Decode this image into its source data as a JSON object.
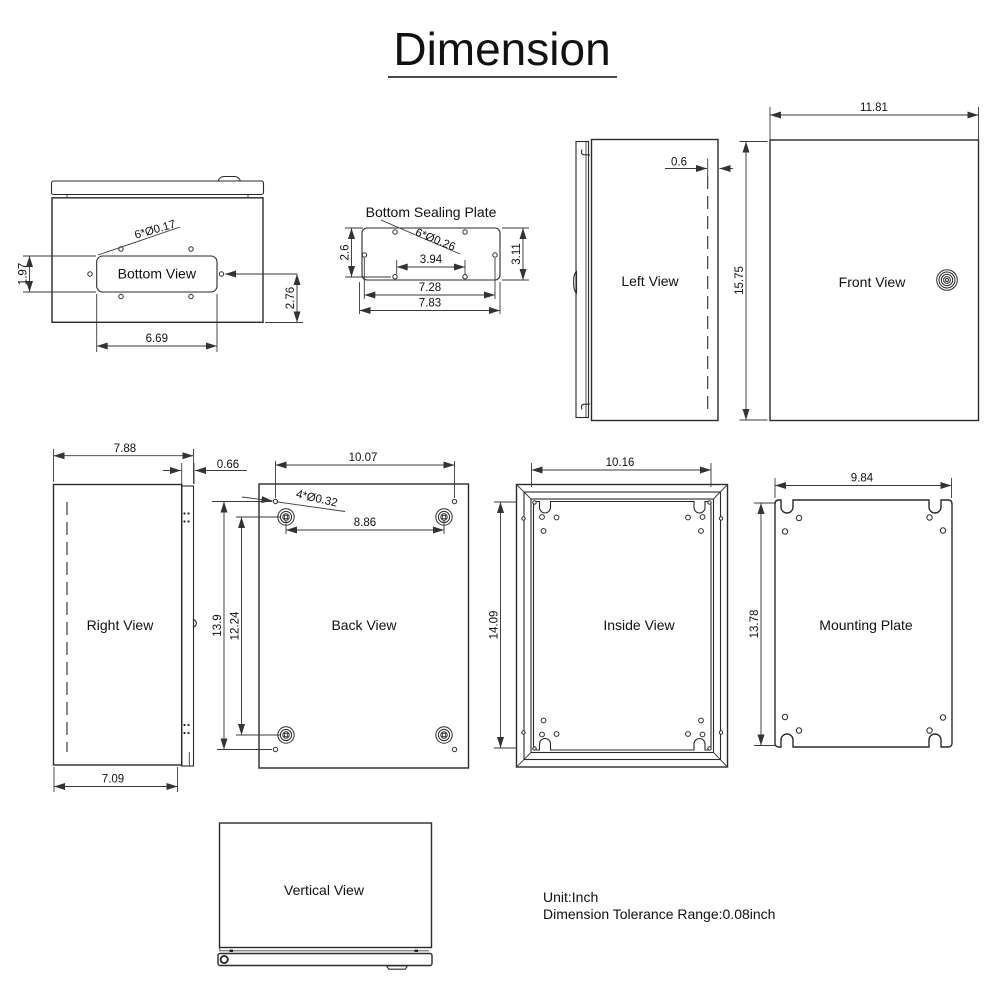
{
  "title": "Dimension",
  "notes": {
    "unit": "Unit:Inch",
    "tolerance": "Dimension Tolerance Range:0.08inch"
  },
  "views": {
    "bottom_view": {
      "label": "Bottom View",
      "hole_note": "6*Ø0.17",
      "dim_hole_offset": "1.97",
      "dim_hole_to_edge": "2.76",
      "dim_cutout_width": "6.69"
    },
    "bottom_sealing_plate": {
      "label": "Bottom Sealing Plate",
      "hole_note": "6*Ø0.26",
      "dim_top_to_holes": "2.6",
      "dim_height": "3.11",
      "dim_inner_holes": "3.94",
      "dim_side_holes": "7.28",
      "dim_width": "7.83"
    },
    "left_view": {
      "label": "Left View",
      "dim_door_thickness": "0.6"
    },
    "front_view": {
      "label": "Front View",
      "dim_width": "11.81",
      "dim_height": "15.75"
    },
    "right_view": {
      "label": "Right View",
      "dim_width": "7.88",
      "dim_door_thickness": "0.66",
      "dim_body_depth": "7.09"
    },
    "back_view": {
      "label": "Back View",
      "hole_note": "4*Ø0.32",
      "dim_hole_span_w": "10.07",
      "dim_boss_span_w": "8.86",
      "dim_hole_span_h": "13.9",
      "dim_boss_span_h": "12.24"
    },
    "inside_view": {
      "label": "Inside View",
      "dim_width": "10.16",
      "dim_height": "14.09"
    },
    "mounting_plate": {
      "label": "Mounting Plate",
      "dim_width": "9.84",
      "dim_height": "13.78"
    },
    "vertical_view": {
      "label": "Vertical View"
    }
  },
  "colors": {
    "line": "#2b2b2b",
    "text": "#111111",
    "background": "#ffffff"
  }
}
